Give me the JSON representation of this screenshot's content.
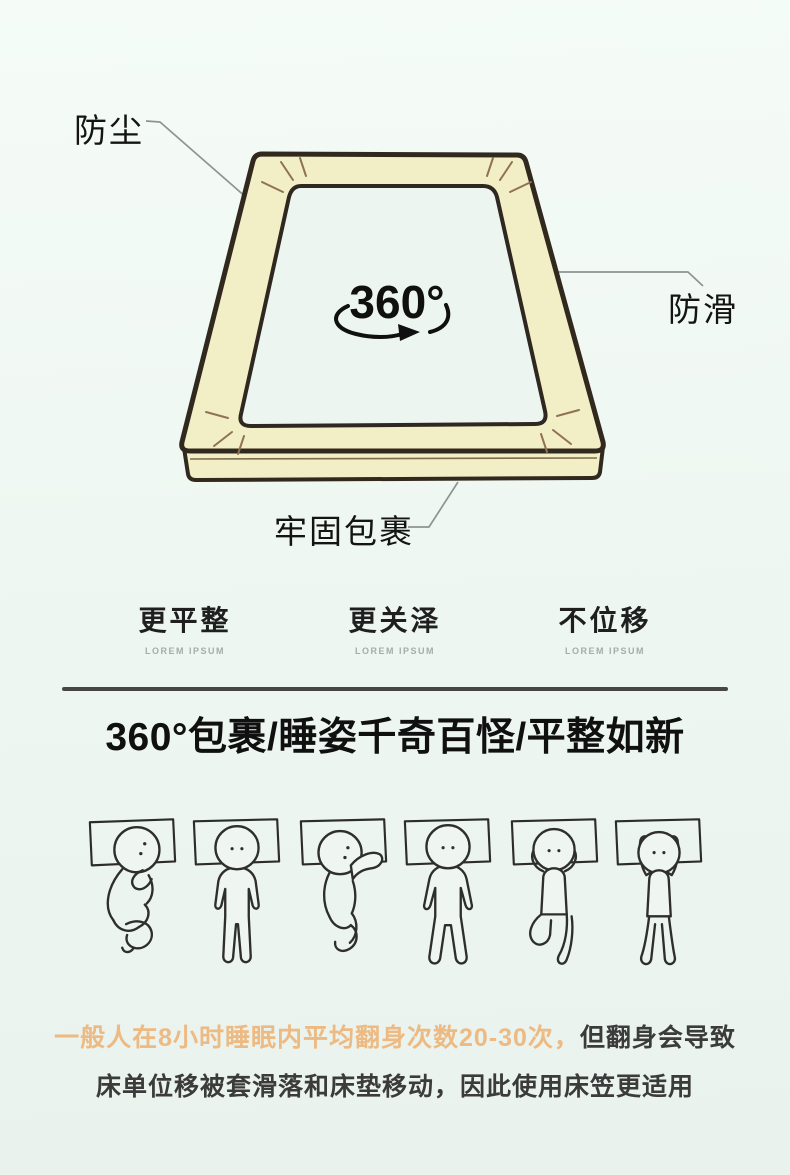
{
  "diagram": {
    "labels": {
      "dustproof": "防尘",
      "antislip": "防滑",
      "wrap": "牢固包裹"
    },
    "rotation_label": "360°",
    "colors": {
      "sheet": "#f2eec5",
      "inner": "#edf5f1",
      "outline": "#32291e",
      "wrinkle": "#8f7254",
      "leader_line": "#8e948f"
    }
  },
  "features": [
    {
      "title": "更平整",
      "subtitle": "LOREM IPSUM"
    },
    {
      "title": "更关泽",
      "subtitle": "LOREM IPSUM"
    },
    {
      "title": "不位移",
      "subtitle": "LOREM IPSUM"
    }
  ],
  "section": {
    "heading": "360°包裹/睡姿千奇百怪/平整如新"
  },
  "figures": [
    "fetal-side-sleeper",
    "back-straight-sleeper",
    "side-arm-on-pillow-sleeper",
    "back-legs-apart-sleeper",
    "hands-behind-head-sleeper",
    "arms-raised-sleeper"
  ],
  "sleep_note": {
    "line1_highlight": "一般人在8小时睡眠内平均翻身次数20-30次，",
    "line1_rest": "但翻身会导致",
    "line2": "床单位移被套滑落和床垫移动，因此使用床笠更适用",
    "highlight_color": "#ecba82",
    "text_color": "#3b3b3b"
  }
}
